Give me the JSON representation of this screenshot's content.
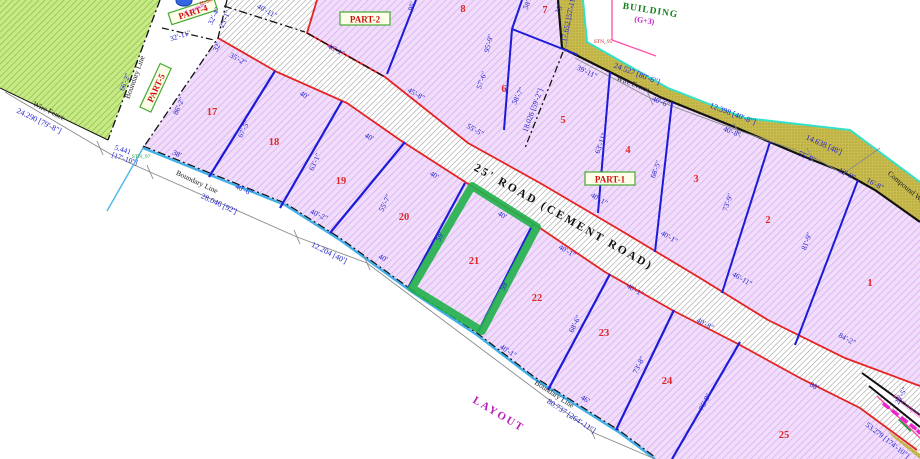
{
  "labels": {
    "road": "25' ROAD (CEMENT ROAD)",
    "layout": "LAYOUT",
    "building": "BUILDING",
    "building_floors": "(G+3)",
    "compound_wall": "Compound Wall",
    "rr_compound": "RR Compound",
    "house": "House",
    "location": "Location",
    "part1": "PART-1",
    "part2": "PART-2",
    "part4": "PART-4",
    "part5": "PART-5",
    "boundary_line": "Boundary Line",
    "wire_fence": "Wire Fence",
    "stn_95": "STN_95",
    "stn_97": "STN_97"
  },
  "plots": {
    "ne": [
      "1",
      "2",
      "3",
      "4",
      "5",
      "6",
      "7",
      "8"
    ],
    "sw": [
      "17",
      "18",
      "19",
      "20",
      "21",
      "22",
      "23",
      "24",
      "25"
    ]
  },
  "dims": {
    "m24290": "24.290 [79'-8\"]",
    "m5441a": "5.441",
    "m5441b": "[17'-10\"]",
    "m28046": "28.046 [92']",
    "m12204": "12.204 [40']",
    "m80737": "80.737 [264'-11\"]",
    "m24527": "24.527 [80'-6\"]",
    "m12398": "12.398 [40'-8\"]",
    "m14638": "14.638 [48']",
    "m17652": "17.652 [57'-11\"]",
    "m18026": "18.026 [59'-2\"]",
    "m53279": "53.279 [174'-10\"]"
  },
  "frontage": {
    "f9": "46'-1\"",
    "f8": "45'-8\"",
    "f6": "55'-5\"",
    "f5": "40'-1\"",
    "f4": "40'-1\"",
    "f3": "46'-11\"",
    "f1": "84'-2\"",
    "f17": "35'-2\"",
    "f18": "40'",
    "f19": "40'",
    "f20": "40'",
    "f21": "40'",
    "f22": "40'-1\"",
    "f23": "40'-1\"",
    "f24": "40'-8\"",
    "f25": "88'",
    "road_top": "40'-11\""
  },
  "depth": {
    "d89": "95'",
    "d78": "95'-9\"",
    "d8r": "57'-6\"",
    "d7a": "58'",
    "d7b": "15'",
    "d56": "58'-7\"",
    "d45": "63'-11\"",
    "d34": "68'-5\"",
    "d23": "73'-9\"",
    "d12": "81'-9\"",
    "d1718": "67'-5\"",
    "d1819": "63'-1\"",
    "d1920": "55'-7\"",
    "d2021": "59'",
    "d2122": "59'",
    "d2223": "68'-6\"",
    "d2324": "73'-8\"",
    "d2425": "75'-9\"",
    "d25r": "25'-5\""
  },
  "edge": {
    "e662": "66'-2\"",
    "e862": "86'-2\"",
    "e3211": "32'-11\"",
    "e324": "32'-4\"",
    "e251": "25'-1\"",
    "e32": "32'",
    "e38": "38'",
    "e3911": "39'-11\"",
    "e406a": "40'-6\"",
    "e408a": "40'-8\"",
    "e559": "55'-9\"",
    "e129": "12'-9\"",
    "e168": "16'-8\"",
    "e406b": "40'-6\"",
    "e402": "40'-2\"",
    "e40b": "40'",
    "e401b": "40'-1\"",
    "e46": "46'"
  },
  "colors": {
    "plot_hatch": "#d99ef2",
    "plot_bg": "#efddfa",
    "green_area": "#7fc241",
    "road_red": "#e52222",
    "division_blue": "#1b1bd8",
    "boundary_cyan": "#42b0e8",
    "wall_yellow": "#c8bc4e",
    "highlight_green": "#25b14e",
    "magenta_band": "#ee22cc"
  }
}
